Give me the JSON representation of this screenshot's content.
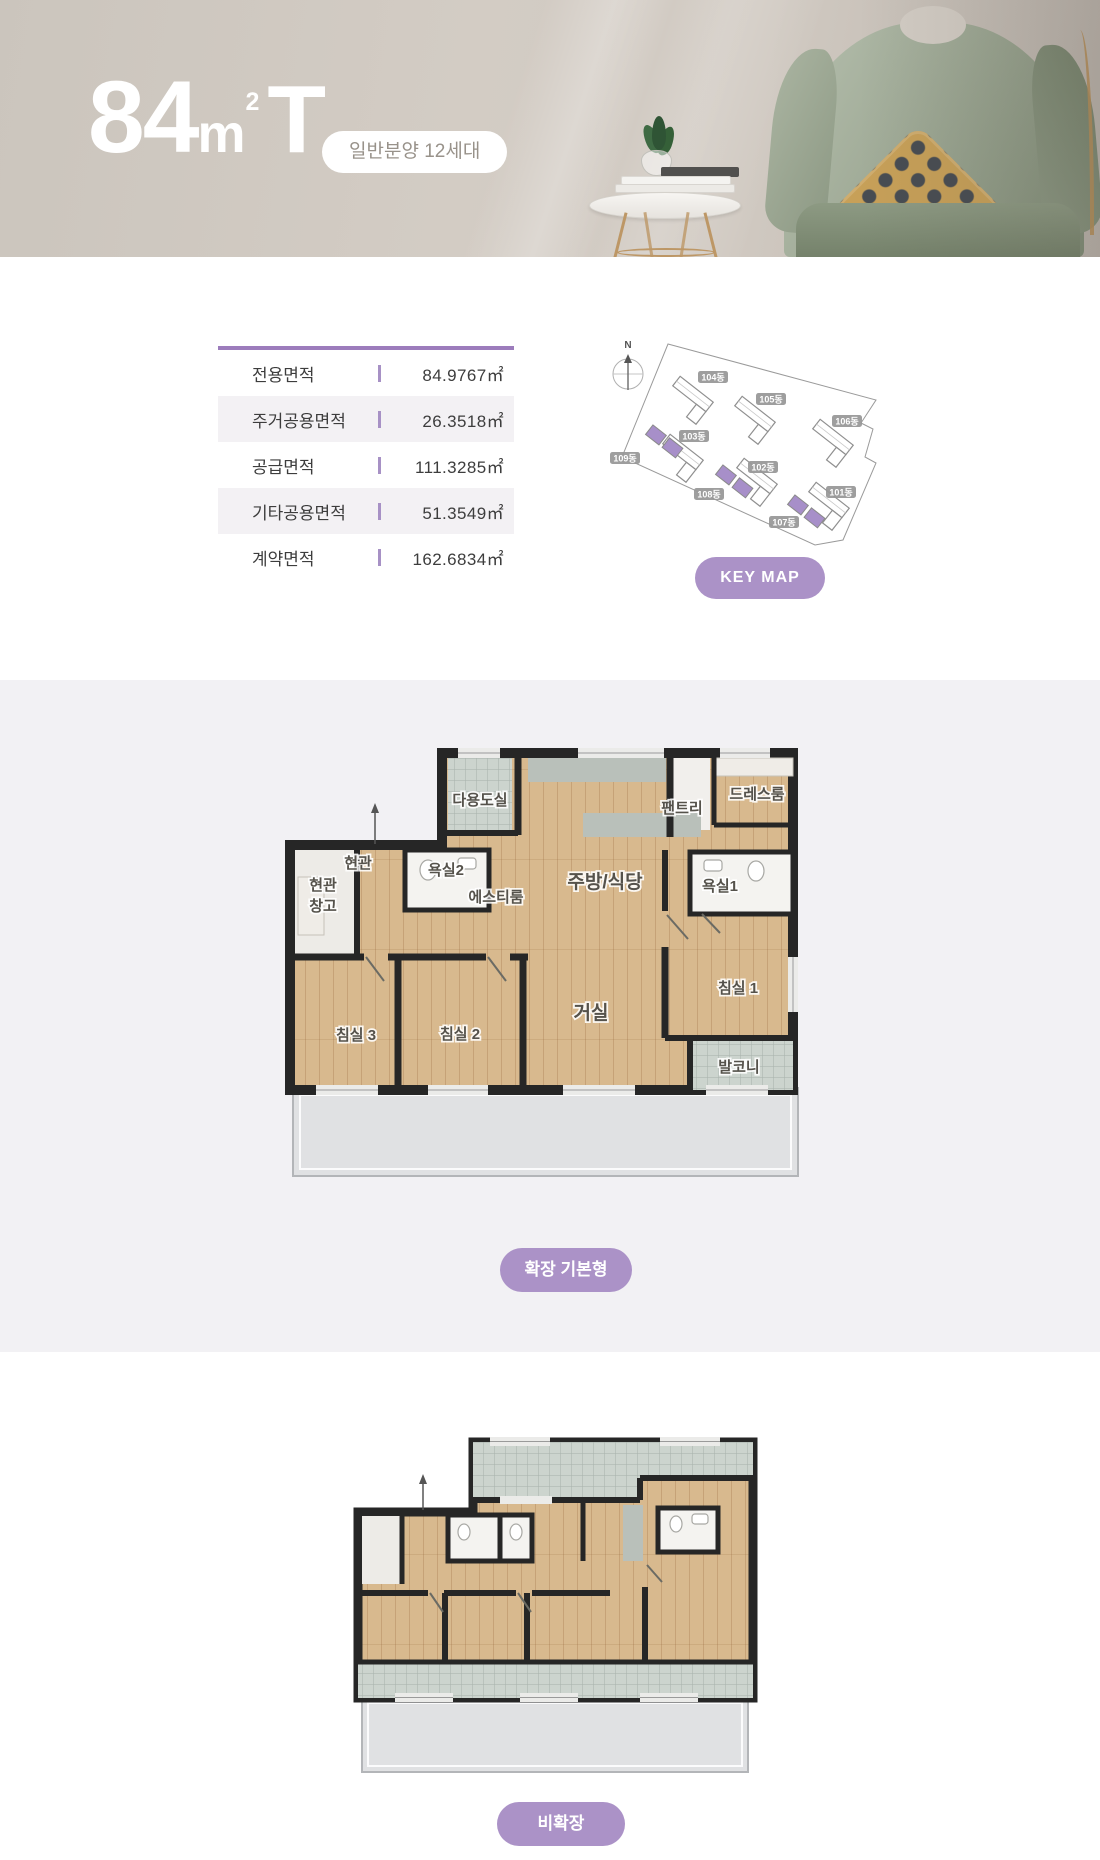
{
  "header": {
    "title_number": "84",
    "title_unit_base": "m",
    "title_unit_sup": "2",
    "title_suffix": "T",
    "sale_badge": "일반분양 12세대"
  },
  "area_table": {
    "rows": [
      {
        "label": "전용면적",
        "value": "84.9767㎡"
      },
      {
        "label": "주거공용면적",
        "value": "26.3518㎡"
      },
      {
        "label": "공급면적",
        "value": "111.3285㎡"
      },
      {
        "label": "기타공용면적",
        "value": "51.3549㎡"
      },
      {
        "label": "계약면적",
        "value": "162.6834㎡"
      }
    ]
  },
  "keymap": {
    "compass_label": "N",
    "button_label": "KEY MAP",
    "buildings": [
      {
        "label": "104동",
        "highlighted": false
      },
      {
        "label": "105동",
        "highlighted": false
      },
      {
        "label": "106동",
        "highlighted": false
      },
      {
        "label": "103동",
        "highlighted": false
      },
      {
        "label": "109동",
        "highlighted": true
      },
      {
        "label": "102동",
        "highlighted": false
      },
      {
        "label": "108동",
        "highlighted": true
      },
      {
        "label": "101동",
        "highlighted": false
      },
      {
        "label": "107동",
        "highlighted": true
      }
    ]
  },
  "floorplan_main": {
    "badge": "확장 기본형",
    "rooms": [
      {
        "label": "다용도실"
      },
      {
        "label": "팬트리"
      },
      {
        "label": "드레스룸"
      },
      {
        "label": "현관"
      },
      {
        "label": "현관"
      },
      {
        "label": "창고"
      },
      {
        "label": "욕실2"
      },
      {
        "label": "에스티룸"
      },
      {
        "label": "주방/식당"
      },
      {
        "label": "욕실1"
      },
      {
        "label": "거실"
      },
      {
        "label": "침실 1"
      },
      {
        "label": "침실 2"
      },
      {
        "label": "침실 3"
      },
      {
        "label": "발코니"
      }
    ]
  },
  "floorplan_sub": {
    "badge": "비확장"
  },
  "colors": {
    "accent_purple": "#ab92c7",
    "unit_highlight_purple": "#a78fc9",
    "table_top_border": "#9c7cbc",
    "hero_background": "#cfc9c1",
    "section_gray": "#f2f1f4",
    "wall_dark": "#262626",
    "wood_floor": "#d8b98e",
    "tile": "#ccd4ce"
  }
}
